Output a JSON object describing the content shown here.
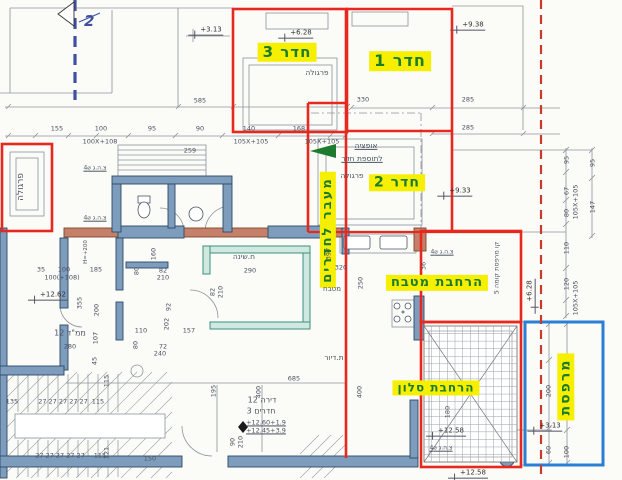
{
  "colors": {
    "highlight_bg": "#f7ef00",
    "highlight_text": "#1b7c2e",
    "addition_outline_red": "#e8281e",
    "balcony_outline_blue": "#2a7fd4",
    "boundary_dashed_red": "#c83a2a",
    "section_line_blue": "#3f51a3",
    "wall_fill": "#7e9dbc",
    "exterior_wall_fill": "#c5806a",
    "bedroom_wall_teal": "#3d8f80"
  },
  "section_marker": {
    "text": "2"
  },
  "yellow_labels": [
    {
      "t": "חדר 3",
      "x": 287,
      "y": 52,
      "fs": 15
    },
    {
      "t": "חדר 1",
      "x": 400,
      "y": 61,
      "fs": 16
    },
    {
      "t": "חדר 2",
      "x": 397,
      "y": 183,
      "fs": 14
    },
    {
      "t": "מעבר לחדרים",
      "x": 328,
      "y": 230,
      "fs": 13,
      "r": 1
    },
    {
      "t": "הרחבת מטבח",
      "x": 437,
      "y": 283,
      "fs": 13
    },
    {
      "t": "הרחבת סלון",
      "x": 436,
      "y": 388,
      "fs": 12
    },
    {
      "t": "מרפסת",
      "x": 566,
      "y": 387,
      "fs": 14,
      "r": 1
    }
  ],
  "levels": [
    {
      "t": "+3.13",
      "x": 206,
      "y": 31
    },
    {
      "t": "+6.28",
      "x": 296,
      "y": 34
    },
    {
      "t": "+9.38",
      "x": 468,
      "y": 26
    },
    {
      "t": "+9.33",
      "x": 455,
      "y": 192
    },
    {
      "t": "+12.62",
      "x": 48,
      "y": 296
    },
    {
      "t": "+12.58",
      "x": 446,
      "y": 432
    },
    {
      "t": "+12.58",
      "x": 468,
      "y": 474
    },
    {
      "t": "+3.13",
      "x": 545,
      "y": 427
    },
    {
      "t": "+6.28",
      "x": 531,
      "y": 296,
      "r": 1
    }
  ],
  "annotations": [
    {
      "t": "פרגולה",
      "x": 317,
      "y": 73
    },
    {
      "t": "פרגולה",
      "x": 352,
      "y": 176
    },
    {
      "t": "פרגולה",
      "x": 22,
      "y": 187,
      "r": 1,
      "fs": 9
    },
    {
      "t": "אופציה",
      "x": 366,
      "y": 146,
      "u": 1
    },
    {
      "t": "לתוספת חדר",
      "x": 362,
      "y": 159,
      "u": 1
    },
    {
      "t": "מטבח",
      "x": 332,
      "y": 290,
      "fs": 7
    },
    {
      "t": "ת.דיור",
      "x": 334,
      "y": 358
    },
    {
      "t": "ח.שינה",
      "x": 244,
      "y": 257
    },
    {
      "t": "ממ\"ד 12",
      "x": 70,
      "y": 334,
      "fs": 8
    },
    {
      "t": "דירה 12",
      "x": 262,
      "y": 401,
      "fs": 8
    },
    {
      "t": "3 חדרים",
      "x": 261,
      "y": 412,
      "fs": 8
    },
    {
      "t": "קו מרפסת קומה 5",
      "x": 497,
      "y": 268,
      "r": 1,
      "fs": 6.5
    },
    {
      "t": "צ.ה.ג ⌀4",
      "x": 95,
      "y": 169,
      "u": 1,
      "fs": 6
    },
    {
      "t": "צ.ה.ג ⌀4",
      "x": 95,
      "y": 219,
      "u": 1,
      "fs": 6
    },
    {
      "t": "צ.ה.ג ⌀4",
      "x": 442,
      "y": 253,
      "u": 1,
      "fs": 6
    },
    {
      "t": "צ.ה.ג ⌀4",
      "x": 441,
      "y": 449,
      "u": 1,
      "fs": 6
    },
    {
      "t": "H=+200",
      "x": 86,
      "y": 252,
      "r": 1,
      "fs": 5.5
    }
  ],
  "dims": [
    {
      "t": "585",
      "x": 200,
      "y": 101
    },
    {
      "t": "155",
      "x": 57,
      "y": 129
    },
    {
      "t": "100",
      "x": 101,
      "y": 129
    },
    {
      "t": "95",
      "x": 152,
      "y": 129
    },
    {
      "t": "90",
      "x": 200,
      "y": 129
    },
    {
      "t": "140",
      "x": 249,
      "y": 129
    },
    {
      "t": "168",
      "x": 299,
      "y": 129
    },
    {
      "t": "100X+108",
      "x": 100,
      "y": 142
    },
    {
      "t": "105X+105",
      "x": 251,
      "y": 142
    },
    {
      "t": "105X+105",
      "x": 322,
      "y": 142
    },
    {
      "t": "330",
      "x": 363,
      "y": 100
    },
    {
      "t": "285",
      "x": 468,
      "y": 100
    },
    {
      "t": "285",
      "x": 468,
      "y": 128
    },
    {
      "t": "95",
      "x": 567,
      "y": 160,
      "r": 1
    },
    {
      "t": "67",
      "x": 567,
      "y": 191,
      "r": 1
    },
    {
      "t": "80",
      "x": 567,
      "y": 213,
      "r": 1
    },
    {
      "t": "105X+105",
      "x": 576,
      "y": 202,
      "r": 1
    },
    {
      "t": "110",
      "x": 567,
      "y": 248,
      "r": 1
    },
    {
      "t": "120",
      "x": 567,
      "y": 284,
      "r": 1
    },
    {
      "t": "105X+105",
      "x": 576,
      "y": 298,
      "r": 1
    },
    {
      "t": "95",
      "x": 593,
      "y": 163,
      "r": 1
    },
    {
      "t": "147",
      "x": 593,
      "y": 207,
      "r": 1
    },
    {
      "t": "200",
      "x": 549,
      "y": 391,
      "r": 1
    },
    {
      "t": "60",
      "x": 549,
      "y": 450,
      "r": 1
    },
    {
      "t": "100",
      "x": 567,
      "y": 452,
      "r": 1
    },
    {
      "t": "35",
      "x": 41,
      "y": 270
    },
    {
      "t": "100",
      "x": 64,
      "y": 270
    },
    {
      "t": "185",
      "x": 96,
      "y": 270
    },
    {
      "t": "100(+108)",
      "x": 62,
      "y": 278
    },
    {
      "t": "259",
      "x": 190,
      "y": 151
    },
    {
      "t": "355",
      "x": 80,
      "y": 303,
      "r": 1
    },
    {
      "t": "200",
      "x": 97,
      "y": 310,
      "r": 1
    },
    {
      "t": "107",
      "x": 96,
      "y": 338,
      "r": 1
    },
    {
      "t": "280",
      "x": 70,
      "y": 347
    },
    {
      "t": "45",
      "x": 95,
      "y": 361,
      "r": 1
    },
    {
      "t": "160",
      "x": 154,
      "y": 254,
      "r": 1
    },
    {
      "t": "80",
      "x": 137,
      "y": 271,
      "r": 1
    },
    {
      "t": "82",
      "x": 163,
      "y": 271
    },
    {
      "t": "210",
      "x": 163,
      "y": 278
    },
    {
      "t": "110",
      "x": 141,
      "y": 331
    },
    {
      "t": "80",
      "x": 136,
      "y": 345,
      "r": 1
    },
    {
      "t": "240",
      "x": 160,
      "y": 354
    },
    {
      "t": "72",
      "x": 163,
      "y": 347
    },
    {
      "t": "157",
      "x": 189,
      "y": 331
    },
    {
      "t": "92",
      "x": 169,
      "y": 307,
      "r": 1
    },
    {
      "t": "202",
      "x": 167,
      "y": 324,
      "r": 1
    },
    {
      "t": "82",
      "x": 213,
      "y": 292,
      "r": 1
    },
    {
      "t": "210",
      "x": 221,
      "y": 292,
      "r": 1
    },
    {
      "t": "290",
      "x": 250,
      "y": 271
    },
    {
      "t": "397",
      "x": 329,
      "y": 254,
      "r": 1
    },
    {
      "t": "685",
      "x": 294,
      "y": 379
    },
    {
      "t": "195",
      "x": 214,
      "y": 391,
      "r": 1
    },
    {
      "t": "400",
      "x": 259,
      "y": 392,
      "r": 1
    },
    {
      "t": "400",
      "x": 360,
      "y": 392,
      "r": 1
    },
    {
      "t": "90",
      "x": 233,
      "y": 442,
      "r": 1
    },
    {
      "t": "210",
      "x": 241,
      "y": 442,
      "r": 1
    },
    {
      "t": "150",
      "x": 150,
      "y": 459
    },
    {
      "t": "115",
      "x": 107,
      "y": 381,
      "r": 1
    },
    {
      "t": "121",
      "x": 107,
      "y": 453,
      "r": 1
    },
    {
      "t": "135",
      "x": 12,
      "y": 402
    },
    {
      "t": "27 27 27 27 27",
      "x": 63,
      "y": 402
    },
    {
      "t": "115",
      "x": 98,
      "y": 402
    },
    {
      "t": "27 27 27 27 27",
      "x": 60,
      "y": 456
    },
    {
      "t": "115",
      "x": 100,
      "y": 456
    },
    {
      "t": "320",
      "x": 341,
      "y": 268
    },
    {
      "t": "250",
      "x": 361,
      "y": 283,
      "r": 1
    },
    {
      "t": "36",
      "x": 424,
      "y": 266,
      "r": 1
    },
    {
      "t": "180",
      "x": 448,
      "y": 412,
      "r": 1
    },
    {
      "t": "+12.60+1.9",
      "x": 266,
      "y": 423,
      "u": 1
    },
    {
      "t": "+12.45+3.9",
      "x": 266,
      "y": 431,
      "u": 1
    }
  ]
}
